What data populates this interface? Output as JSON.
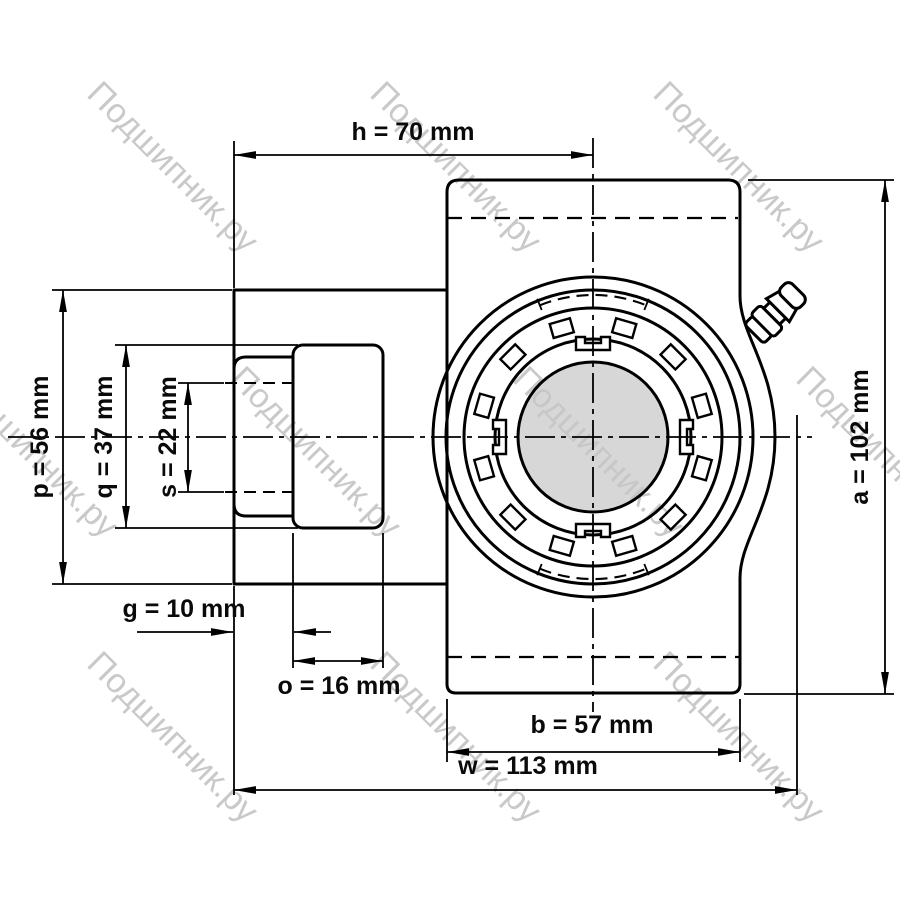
{
  "watermark": {
    "text": "Подшипник.ру",
    "color": "#c7c7c7"
  },
  "dimensions": {
    "h": {
      "label": "h = 70 mm"
    },
    "a": {
      "label": "a = 102 mm"
    },
    "p": {
      "label": "p = 56 mm"
    },
    "q": {
      "label": "q = 37 mm"
    },
    "s": {
      "label": "s = 22 mm"
    },
    "g": {
      "label": "g = 10 mm"
    },
    "o": {
      "label": "o = 16 mm"
    },
    "b": {
      "label": "b = 57 mm"
    },
    "w": {
      "label": "w = 113 mm"
    }
  },
  "drawing": {
    "shaft_fill": "#d7d7d7",
    "line_color": "#000000"
  }
}
